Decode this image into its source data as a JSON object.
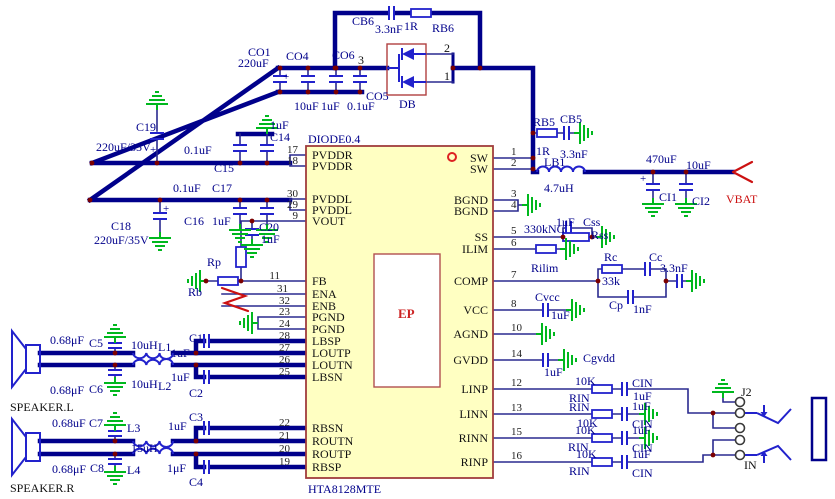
{
  "ic": {
    "part_number": "HTA8128MTE",
    "top_label": "DIODE0.4",
    "ep_label": "EP",
    "left_pins": [
      {
        "num": "17",
        "name": "PVDDR"
      },
      {
        "num": "18",
        "name": "PVDDR"
      },
      {
        "num": "30",
        "name": "PVDDL"
      },
      {
        "num": "29",
        "name": "PVDDL"
      },
      {
        "num": "9",
        "name": "VOUT"
      },
      {
        "num": "11",
        "name": "FB"
      },
      {
        "num": "31",
        "name": "ENA"
      },
      {
        "num": "32",
        "name": "ENB"
      },
      {
        "num": "23",
        "name": "PGND"
      },
      {
        "num": "24",
        "name": "PGND"
      },
      {
        "num": "28",
        "name": "LBSP"
      },
      {
        "num": "27",
        "name": "LOUTP"
      },
      {
        "num": "26",
        "name": "LOUTN"
      },
      {
        "num": "25",
        "name": "LBSN"
      },
      {
        "num": "22",
        "name": "RBSN"
      },
      {
        "num": "21",
        "name": "ROUTN"
      },
      {
        "num": "20",
        "name": "ROUTP"
      },
      {
        "num": "19",
        "name": "RBSP"
      }
    ],
    "right_pins": [
      {
        "num": "1",
        "name": "SW"
      },
      {
        "num": "2",
        "name": "SW"
      },
      {
        "num": "3",
        "name": "BGND"
      },
      {
        "num": "4",
        "name": "BGND"
      },
      {
        "num": "5",
        "name": "SS"
      },
      {
        "num": "6",
        "name": "ILIM"
      },
      {
        "num": "7",
        "name": "COMP"
      },
      {
        "num": "8",
        "name": "VCC"
      },
      {
        "num": "10",
        "name": "AGND"
      },
      {
        "num": "14",
        "name": "GVDD"
      },
      {
        "num": "12",
        "name": "LINP"
      },
      {
        "num": "13",
        "name": "LINN"
      },
      {
        "num": "15",
        "name": "RINN"
      },
      {
        "num": "16",
        "name": "RINP"
      }
    ]
  },
  "labels": {
    "cb6_ref": "CB6",
    "cb6_val": "3.3nF",
    "rb6_val": "1R",
    "rb6_ref": "RB6",
    "co1_ref": "CO1",
    "co1_val": "220uF",
    "co4_ref": "CO4",
    "co4_val": "10uF",
    "co6_ref": "CO6",
    "co6_val": "1uF",
    "co5_ref": "CO5",
    "co5_val": "0.1uF",
    "node3": "3",
    "plus": "+",
    "db_pin2": "2",
    "db_pin1": "1",
    "db_ref": "DB",
    "c19_ref": "C19",
    "c19_val": "220uF/35V",
    "c14_val": "1uF",
    "c14_ref": "C14",
    "c15_val": "0.1uF",
    "c15_ref": "C15",
    "c16_val": "0.1uF",
    "c17_ref": "C17",
    "c16_ref": "C16",
    "c17_val": "1uF",
    "c18_ref": "C18",
    "c18_val": "220uF/35V",
    "c20_ref": "C20",
    "c20_val": "1uF",
    "rp_ref": "Rp",
    "rb_ref": "Rb",
    "c5_val": "0.68μF",
    "c5_ref": "C5",
    "l1_val": "10uH",
    "l1_ref": "L1",
    "c1_ref": "C1",
    "c1_val": "1uF",
    "c6_val": "0.68μF",
    "c6_ref": "C6",
    "l2_val": "10uH",
    "l2_ref": "L2",
    "c2_val": "1uF",
    "c2_ref": "C2",
    "speaker_l": "SPEAKER.L",
    "c7_val": "0.68uF",
    "c7_ref": "C7",
    "l3_ref": "L3",
    "c3_val": "1uF",
    "c3_ref": "C3",
    "l34_val": "15uH",
    "c8_val": "0.68μF",
    "c8_ref": "C8",
    "l4_ref": "L4",
    "c4_val": "1μF",
    "c4_ref": "C4",
    "speaker_r": "SPEAKER.R",
    "rb5_ref": "RB5",
    "rb5_val": "1R",
    "cb5_ref": "CB5",
    "cb5_val": "3.3nF",
    "lb1_ref": "LB1",
    "lb1_val": "4.7uH",
    "ci1_val": "470uF",
    "ci2_val": "10uF",
    "ci1_ref": "CI1",
    "ci2_ref": "CI2",
    "vbat": "VBAT",
    "ss_nc": "330kNC",
    "css_val": "1uF",
    "css_ref": "Css",
    "rss_ref": "Rss",
    "rilim_ref": "Rilim",
    "rc_ref": "Rc",
    "rc_val": "33k",
    "cc_ref": "Cc",
    "comp_cap_val": "3.3nF",
    "cp_ref": "Cp",
    "cp_val": "1nF",
    "cvcc_ref": "Cvcc",
    "cvcc_val": "1uF",
    "cgvdd_ref": "Cgvdd",
    "cgvdd_val": "1uF",
    "j2_ref": "J2",
    "in_label": "IN"
  },
  "input_rows": [
    {
      "pin": "12",
      "res_val": "10K",
      "res_ref": "RIN",
      "cap_ref": "CIN",
      "cap_val": "1uF"
    },
    {
      "pin": "13",
      "res_ref": "RIN",
      "res_val": "10K",
      "cap_val": "1uF",
      "cap_ref": "CIN"
    },
    {
      "pin": "15",
      "res_val": "10K",
      "res_ref": "RIN",
      "cap_val": "1uF",
      "cap_ref": "CIN"
    },
    {
      "pin": "16",
      "res_val": "10K",
      "res_ref": "RIN",
      "cap_val": "1uF",
      "cap_ref": "CIN"
    }
  ]
}
